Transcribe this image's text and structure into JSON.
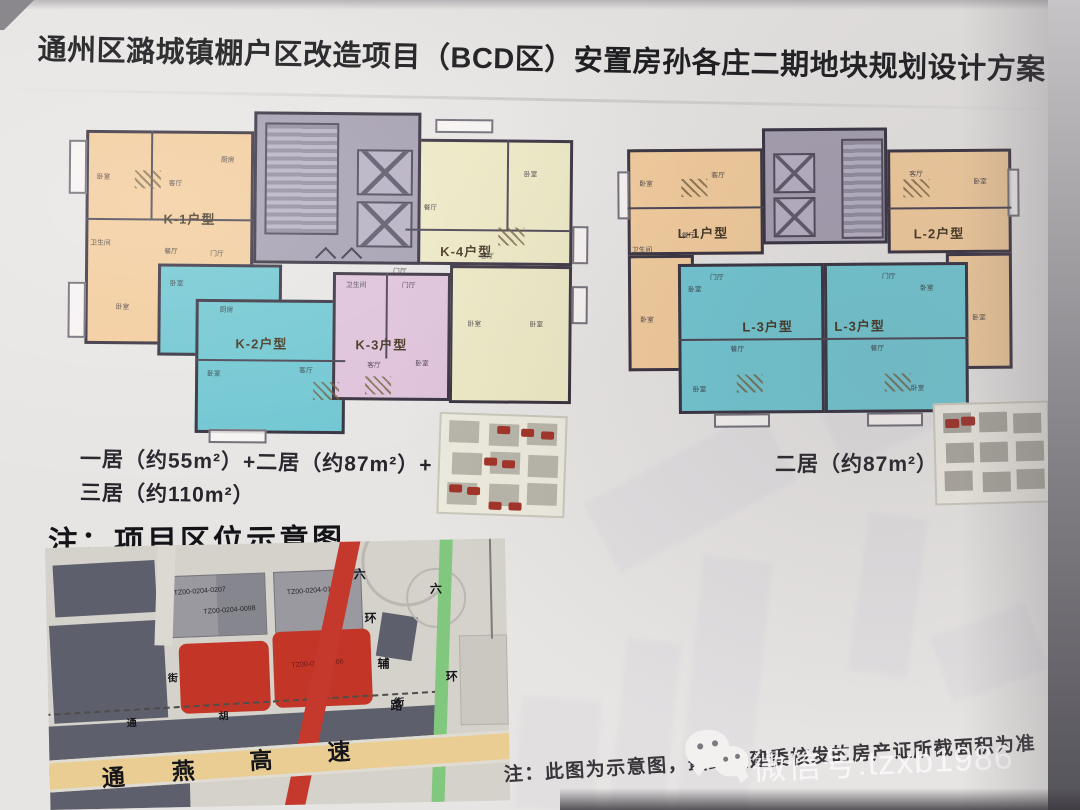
{
  "title": "通州区潞城镇棚户区改造项目（BCD区）安置房孙各庄二期地块规划设计方案",
  "floor_plans": {
    "room_labels": {
      "bedroom": "卧室",
      "living": "客厅",
      "dining": "餐厅",
      "kitchen": "厨房",
      "bathroom": "卫生间",
      "foyer": "门厅"
    },
    "left": {
      "units": {
        "k1": {
          "label": "K-1户型",
          "color": "#f2cb9a"
        },
        "k2": {
          "label": "K-2户型",
          "color": "#6ec6d1"
        },
        "k3": {
          "label": "K-3户型",
          "color": "#dec1da"
        },
        "k4": {
          "label": "K-4户型",
          "color": "#ece8c3"
        }
      },
      "caption_line1": "一居（约55m²）+二居（约87m²）+",
      "caption_line2": "三居（约110m²）"
    },
    "right": {
      "units": {
        "l1": {
          "label": "L-1户型",
          "color": "#f2cb9a"
        },
        "l2": {
          "label": "L-2户型",
          "color": "#f2cb9a"
        },
        "l3a": {
          "label": "L-3户型",
          "color": "#6ec6d1"
        },
        "l3b": {
          "label": "L-3户型",
          "color": "#6ec6d1"
        }
      },
      "caption": "二居（约87m²）"
    }
  },
  "location": {
    "heading": "注：项目区位示意图",
    "map": {
      "parcel_labels": [
        "TZ00-0204-0207",
        "TZ00-0204-0098",
        "TZ00-0204-0163",
        "TZ00-0204-0106"
      ],
      "ring_aux_road": [
        "六",
        "环",
        "辅",
        "路"
      ],
      "ring_road": [
        "六",
        "环"
      ],
      "expressway": [
        "通",
        "燕",
        "高",
        "速"
      ],
      "street": [
        "通",
        "胡",
        "南",
        "街"
      ],
      "cross_street": "街"
    }
  },
  "footnote": "注：此图为示意图，最终以建委核发的房产证所截面积为准",
  "watermark": {
    "label": "微信号:tzxb1986",
    "icon": "wechat-icon"
  },
  "colors": {
    "unit_peach": "#f2cb9a",
    "unit_cyan": "#6ec6d1",
    "unit_pink": "#dec1da",
    "unit_cream": "#ece8c3",
    "core_gray": "#a39daf",
    "wall": "#352f3d",
    "map_red_parcel": "#c23527",
    "map_slate": "#5d5f6c",
    "map_gray": "#9a99a0",
    "ring_aux_road": "#c5392c",
    "ring_road": "#82c77e",
    "expressway": "#e9cd92"
  }
}
